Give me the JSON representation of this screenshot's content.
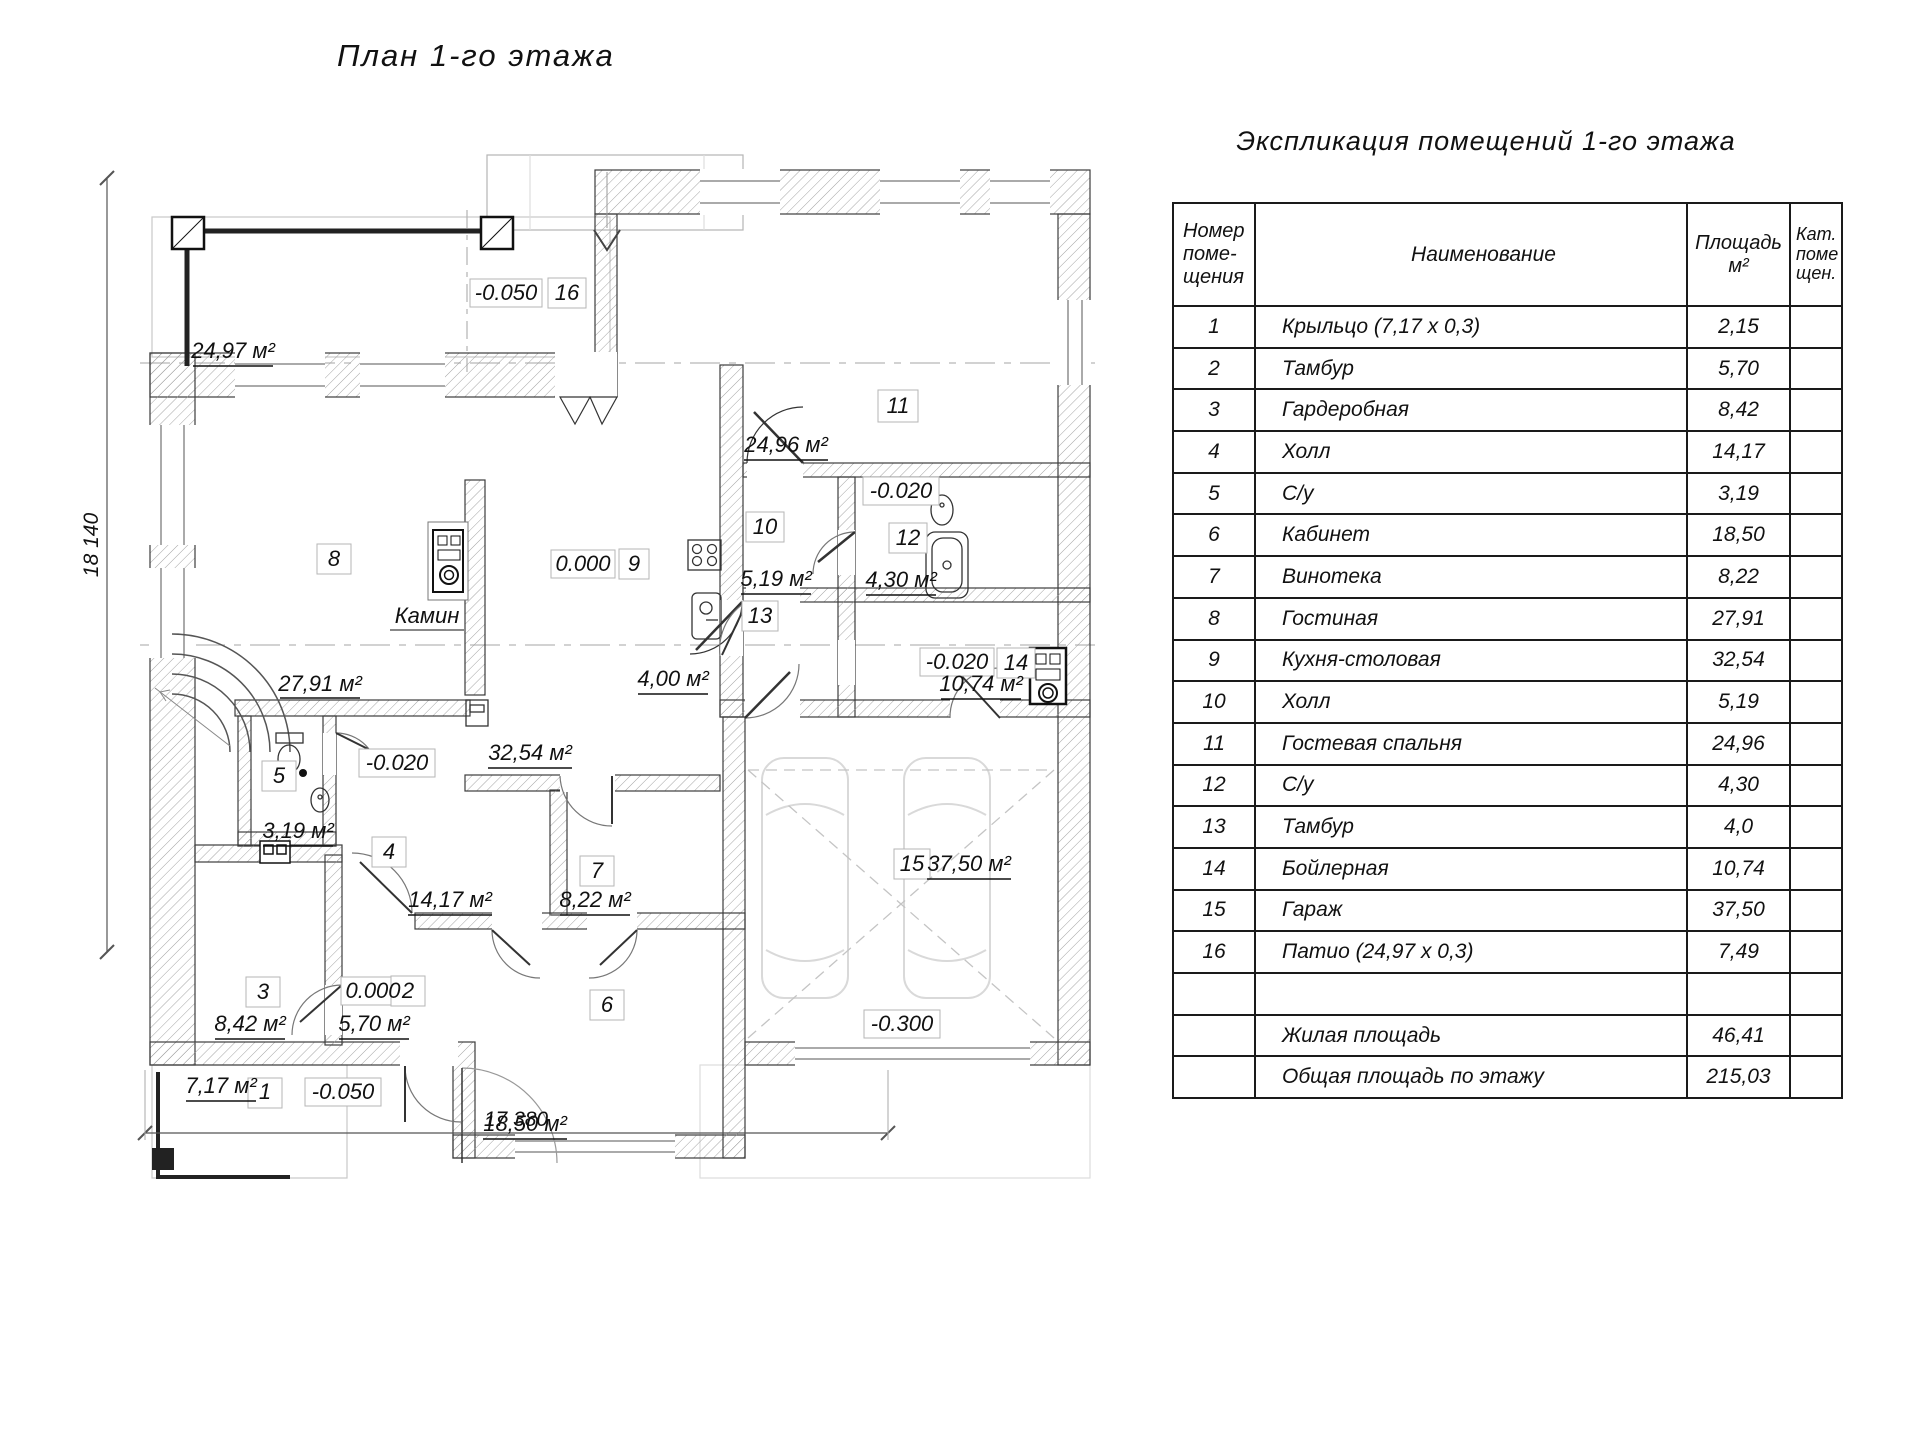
{
  "page": {
    "title": "План 1-го этажа"
  },
  "dimensions": {
    "left": "18 140",
    "bottom": "17 380"
  },
  "plan": {
    "labels": {
      "patio_area": "24,97 м²",
      "patio_elev": "-0.050",
      "patio_num": "16",
      "r11_num": "11",
      "r11_area": "24,96 м²",
      "elev_top": "-0.020",
      "r10_num": "10",
      "r12_num": "12",
      "r8_num": "8",
      "elev_kitchen": "0.000",
      "r9_num": "9",
      "r10_area": "5,19 м²",
      "r12_area": "4,30 м²",
      "fireplace": "Камин",
      "r13_num": "13",
      "elev_boiler": "-0.020",
      "r14_num": "14",
      "r14_area": "10,74 м²",
      "r13_area": "4,00 м²",
      "r8_area": "27,91 м²",
      "r5_num": "5",
      "elev_wc": "-0.020",
      "r9_area": "32,54 м²",
      "r5_area": "3,19 м²",
      "r4_num": "4",
      "r15_num": "15",
      "r15_area": "37,50 м²",
      "r4_area": "14,17 м²",
      "r7_num": "7",
      "r7_area": "8,22 м²",
      "r3_num": "3",
      "elev_tambour": "0.000",
      "r2_num": "2",
      "r6_num": "6",
      "r3_area": "8,42 м²",
      "r2_area": "5,70 м²",
      "elev_garage": "-0.300",
      "r1_area": "7,17 м²",
      "r1_num": "1",
      "elev_porch": "-0.050",
      "r6_area": "18,50 м²"
    }
  },
  "table": {
    "title": "Экспликация помещений 1-го этажа",
    "header": {
      "number_lines": [
        "Номер",
        "поме-",
        "щения"
      ],
      "name": "Наименование",
      "area_lines": [
        "Площадь",
        "м²"
      ],
      "cat_lines": [
        "Кат.",
        "поме",
        "щен."
      ]
    },
    "rows": [
      {
        "num": "1",
        "name": "Крыльцо (7,17 х 0,3)",
        "area": "2,15",
        "cat": ""
      },
      {
        "num": "2",
        "name": "Тамбур",
        "area": "5,70",
        "cat": ""
      },
      {
        "num": "3",
        "name": "Гардеробная",
        "area": "8,42",
        "cat": ""
      },
      {
        "num": "4",
        "name": "Холл",
        "area": "14,17",
        "cat": ""
      },
      {
        "num": "5",
        "name": "С/у",
        "area": "3,19",
        "cat": ""
      },
      {
        "num": "6",
        "name": "Кабинет",
        "area": "18,50",
        "cat": ""
      },
      {
        "num": "7",
        "name": "Винотека",
        "area": "8,22",
        "cat": ""
      },
      {
        "num": "8",
        "name": "Гостиная",
        "area": "27,91",
        "cat": ""
      },
      {
        "num": "9",
        "name": "Кухня-столовая",
        "area": "32,54",
        "cat": ""
      },
      {
        "num": "10",
        "name": "Холл",
        "area": "5,19",
        "cat": ""
      },
      {
        "num": "11",
        "name": "Гостевая спальня",
        "area": "24,96",
        "cat": ""
      },
      {
        "num": "12",
        "name": "С/у",
        "area": "4,30",
        "cat": ""
      },
      {
        "num": "13",
        "name": "Тамбур",
        "area": "4,0",
        "cat": ""
      },
      {
        "num": "14",
        "name": "Бойлерная",
        "area": "10,74",
        "cat": ""
      },
      {
        "num": "15",
        "name": "Гараж",
        "area": "37,50",
        "cat": ""
      },
      {
        "num": "16",
        "name": "Патио (24,97 х 0,3)",
        "area": "7,49",
        "cat": ""
      },
      {
        "num": "",
        "name": "",
        "area": "",
        "cat": ""
      },
      {
        "num": "",
        "name": "Жилая площадь",
        "area": "46,41",
        "cat": ""
      },
      {
        "num": "",
        "name": "Общая площадь по этажу",
        "area": "215,03",
        "cat": ""
      }
    ]
  }
}
